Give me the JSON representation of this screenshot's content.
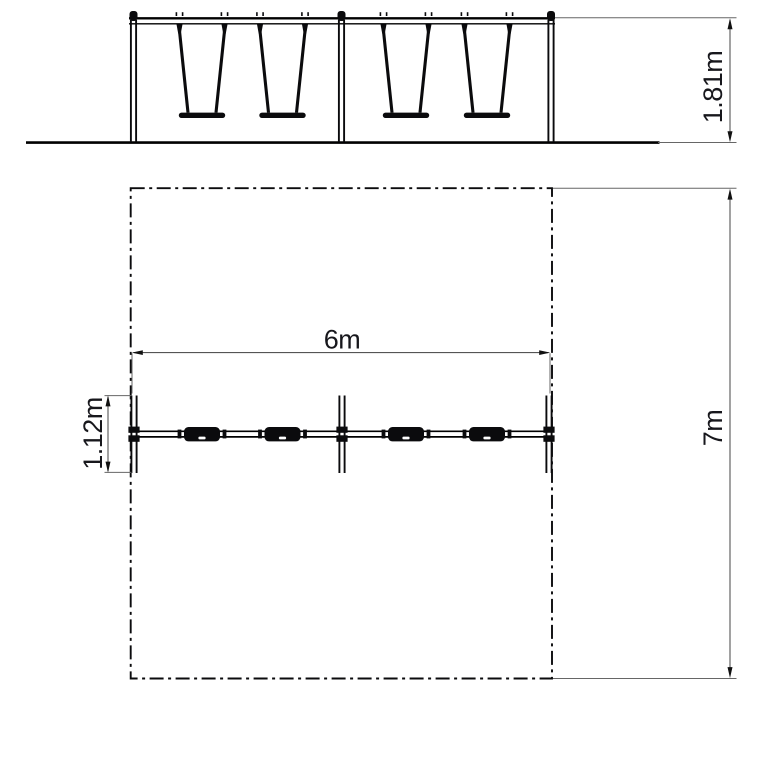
{
  "drawing": {
    "background_color": "#ffffff",
    "line_color": "#000000",
    "views": {
      "front_elevation": {
        "swing_count": 4,
        "post_count": 3,
        "dimensions": {
          "height": "1.81m"
        }
      },
      "plan": {
        "seat_count": 4,
        "boundary_style": "dash-dot",
        "dimensions": {
          "frame_width": "6m",
          "safety_area_depth": "7m",
          "frame_depth": "1.12m"
        }
      }
    }
  }
}
